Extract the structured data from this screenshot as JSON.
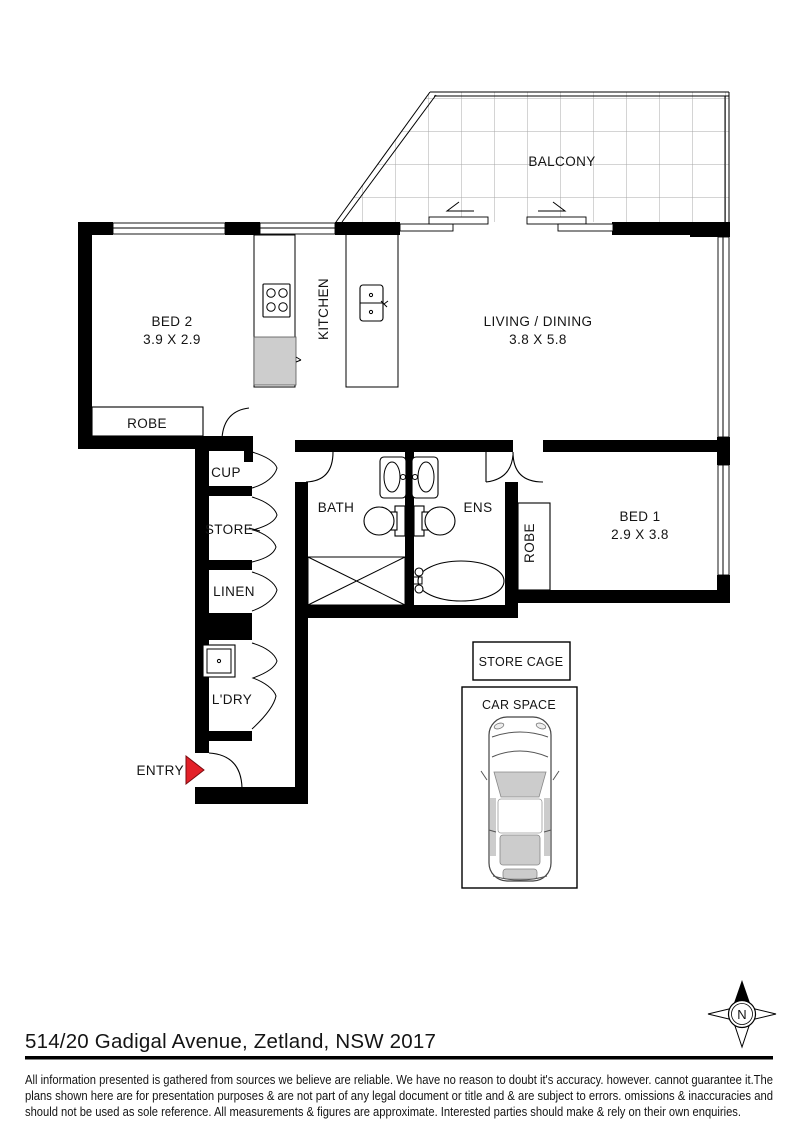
{
  "plan": {
    "labels": {
      "balcony": "BALCONY",
      "bed2": "BED 2",
      "bed2_dims": "3.9 X 2.9",
      "robe_bed2": "ROBE",
      "kitchen": "KITCHEN",
      "living": "LIVING / DINING",
      "living_dims": "3.8 X 5.8",
      "bed1": "BED 1",
      "bed1_dims": "2.9 X 3.8",
      "robe_bed1": "ROBE",
      "bath": "BATH",
      "ens": "ENS",
      "cup": "CUP",
      "store": "STORE",
      "linen": "LINEN",
      "ldry": "L'DRY",
      "entry": "ENTRY",
      "store_cage": "STORE CAGE",
      "car_space": "CAR SPACE",
      "compass_n": "N"
    }
  },
  "footer": {
    "address": "514/20 Gadigal Avenue, Zetland, NSW 2017",
    "disclaimer_lines": [
      "All information presented is gathered from sources we believe are reliable. We have no reason to doubt it's accuracy. however. cannot guarantee it.The",
      "plans shown here are for presentation purposes & are not part of any legal document or title and & are subject to errors. omissions & inaccuracies and",
      "should not be used as sole reference. All measurements & figures are approximate. Interested parties should make & rely on their own enquiries."
    ]
  },
  "colors": {
    "wall": "#000000",
    "entry_arrow": "#e32028",
    "fixture_gray": "#cdcdcd",
    "balcony_grid": "#a8a8a8"
  }
}
